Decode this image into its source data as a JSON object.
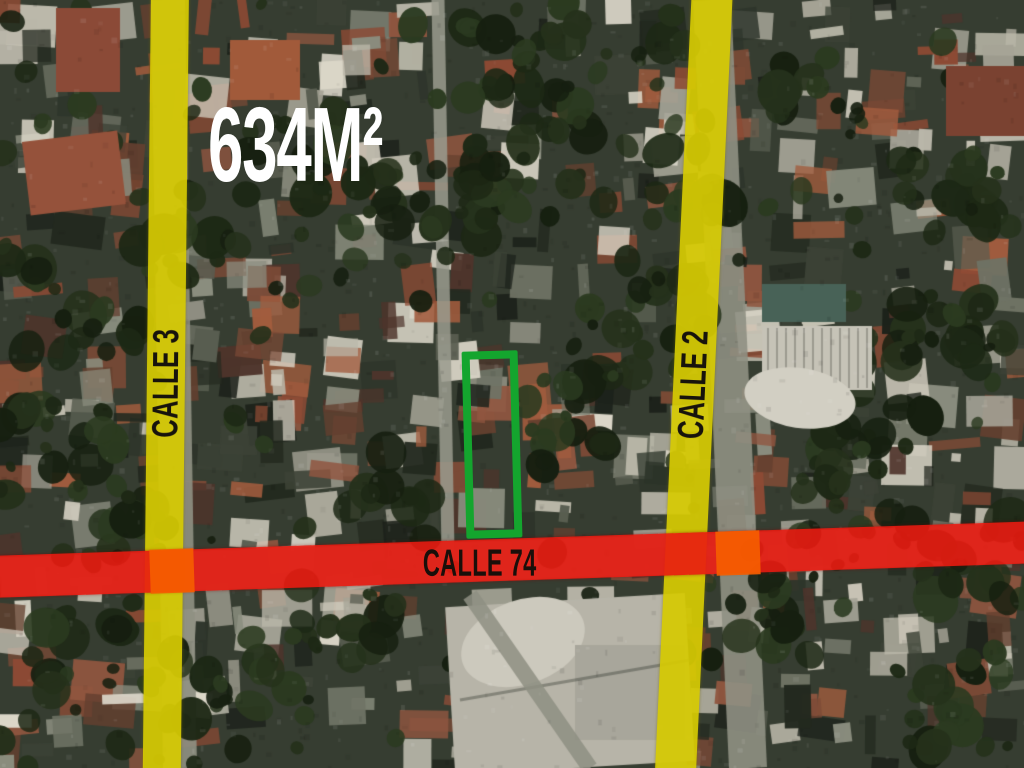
{
  "map": {
    "area_label": "634M²",
    "streets": [
      {
        "name": "CALLE 3",
        "orientation": "vertical",
        "overlay_color": "#d5c902"
      },
      {
        "name": "CALLE 2",
        "orientation": "vertical",
        "overlay_color": "#d5c902"
      },
      {
        "name": "CALLE 74",
        "orientation": "horizontal",
        "overlay_color": "#e81910"
      }
    ],
    "lot": {
      "outline_color": "#14a52e",
      "shape": "rectangle"
    },
    "colors": {
      "intersection_blend": "#f55e00",
      "street_label_text": "#17130c",
      "area_label_text": "#ffffff"
    }
  }
}
